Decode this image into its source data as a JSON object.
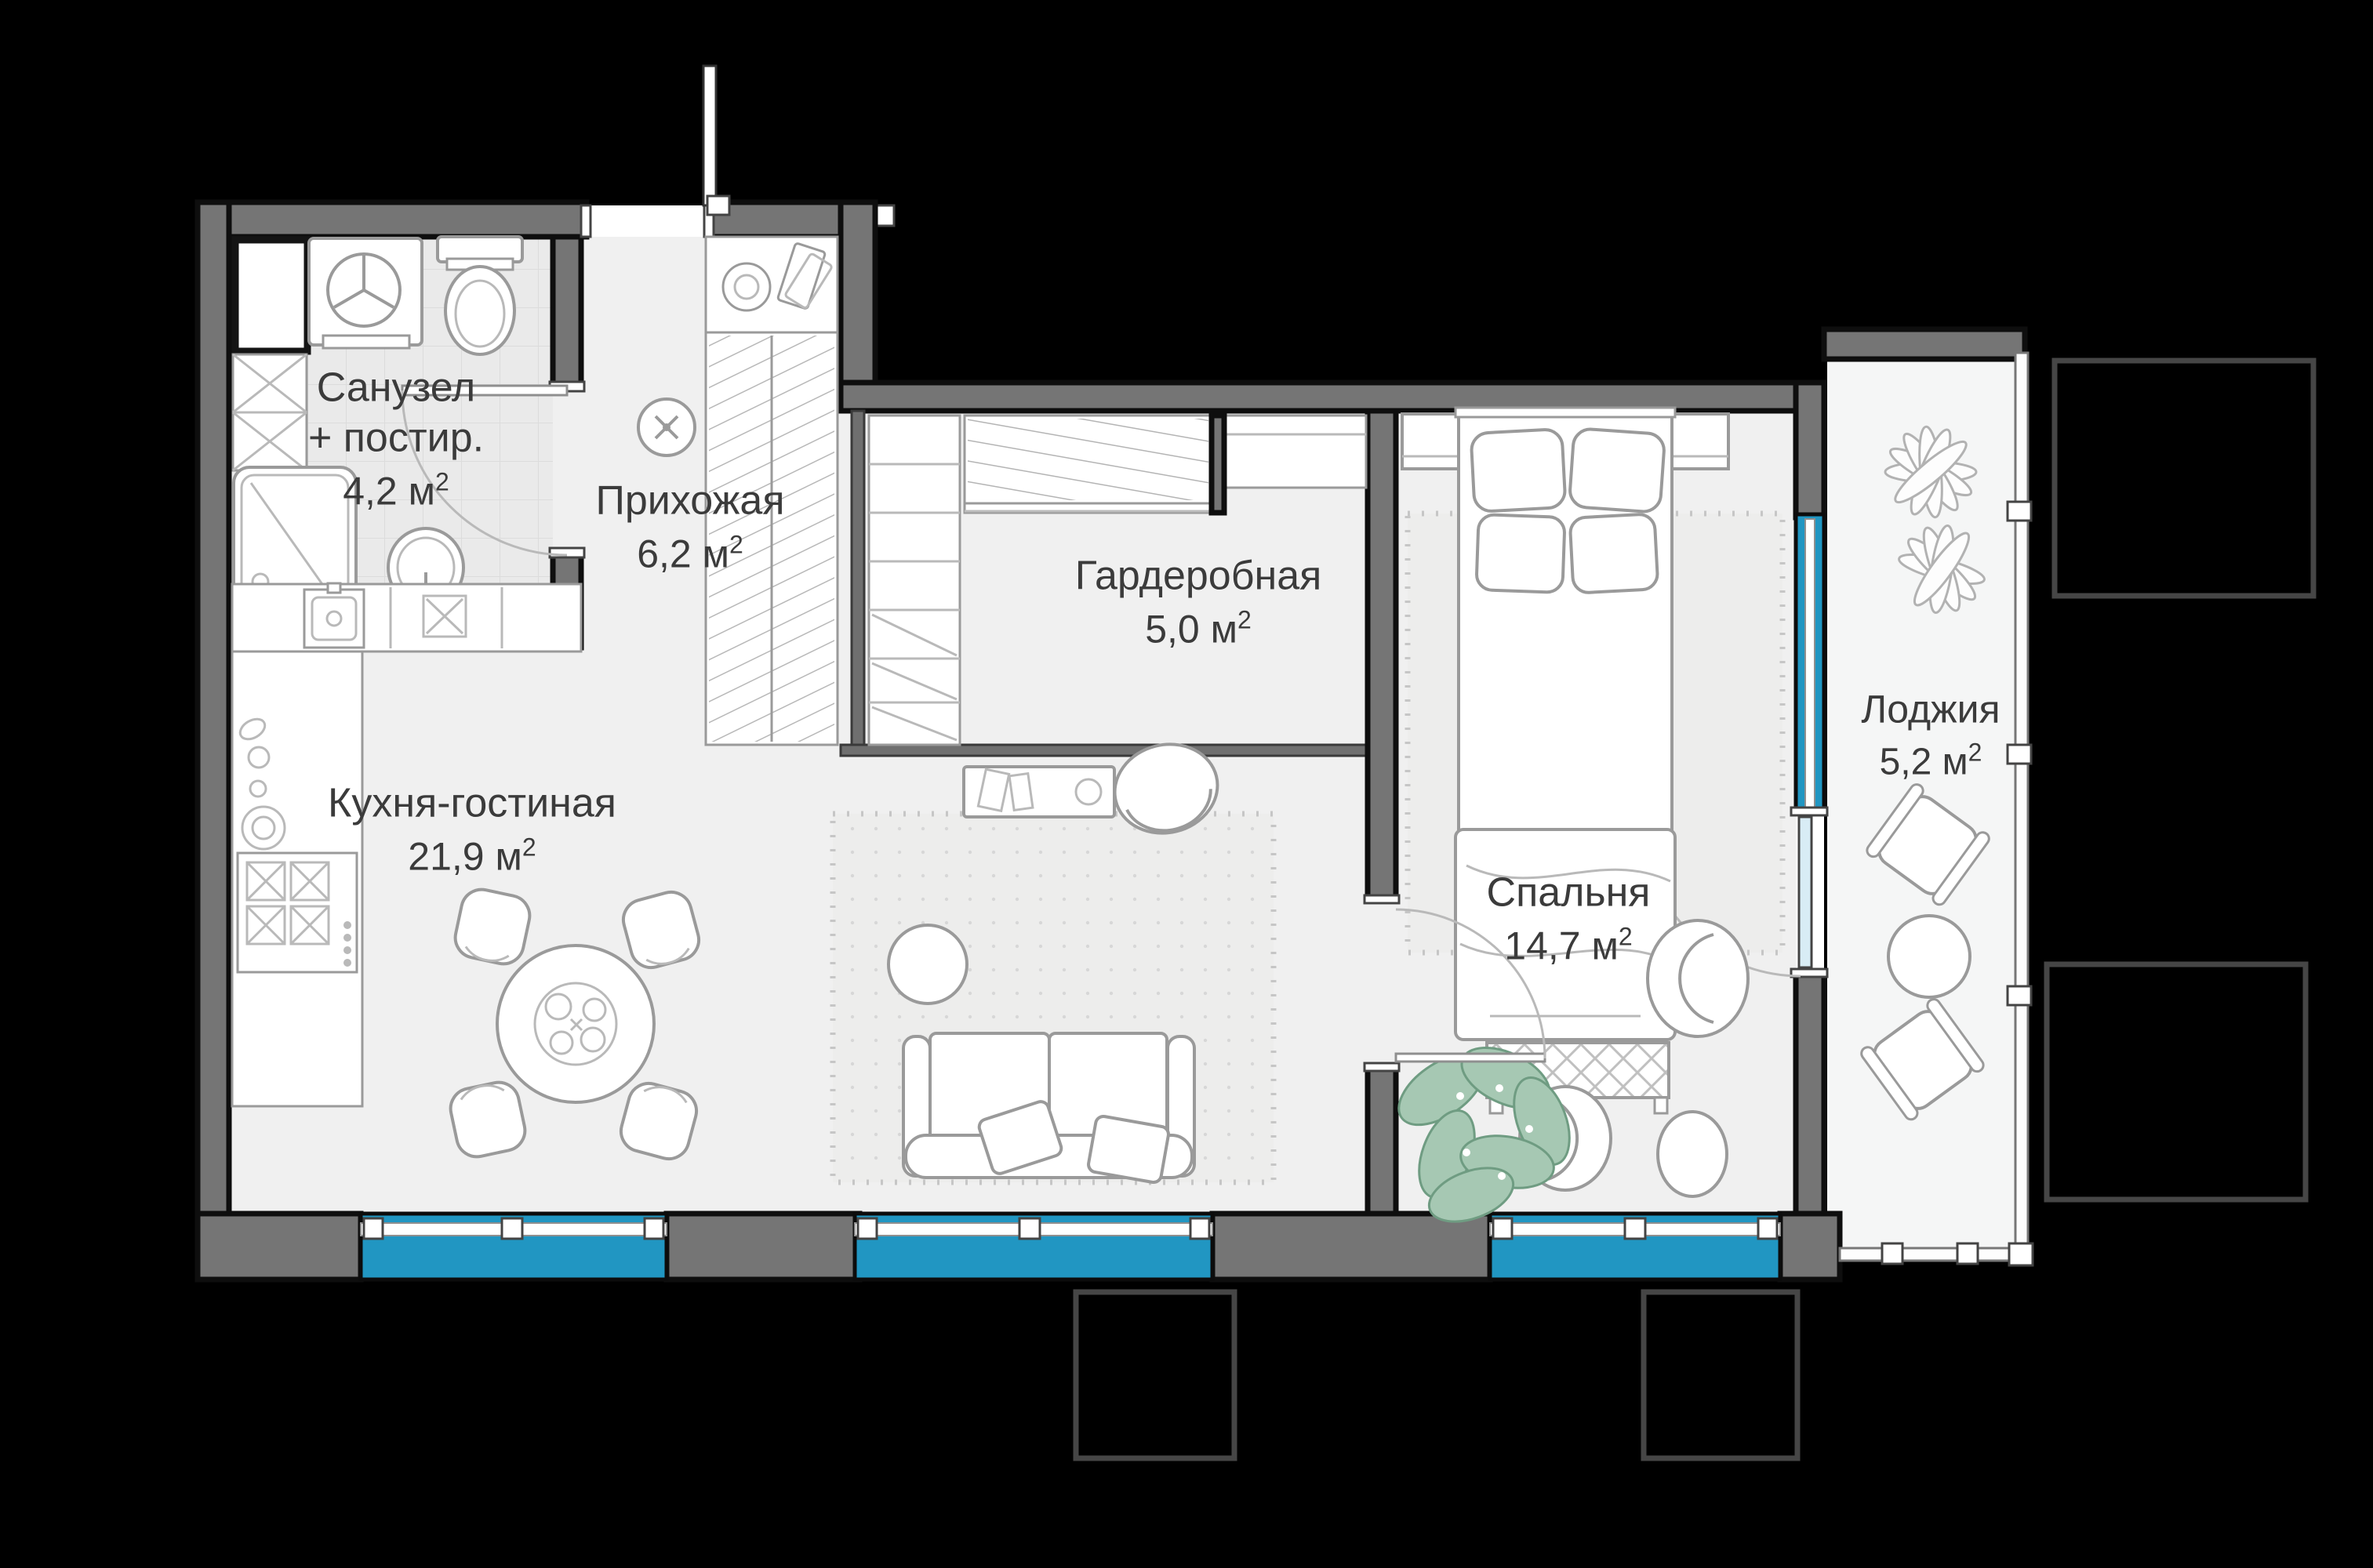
{
  "rooms": {
    "bathroom": {
      "name_line1": "Санузел",
      "name_line2": "+ постир.",
      "area": "4,2"
    },
    "hallway": {
      "name": "Прихожая",
      "area": "6,2"
    },
    "wardrobe": {
      "name": "Гардеробная",
      "area": "5,0"
    },
    "bedroom": {
      "name": "Спальня",
      "area": "14,7"
    },
    "kitchen_living": {
      "name": "Кухня-гостиная",
      "area": "21,9"
    },
    "loggia": {
      "name": "Лоджия",
      "area": "5,2"
    }
  },
  "unit": {
    "base": "м",
    "sup": "2"
  },
  "colors": {
    "background": "#000000",
    "wall": "#757575",
    "floor": "#f0f0f0",
    "tile": "#eaeaea",
    "window": "#2196c2",
    "glass": "#d8ecf5",
    "line": "#9a9a9a",
    "plant": "#a6c8b3",
    "text": "#3b3b3b"
  }
}
